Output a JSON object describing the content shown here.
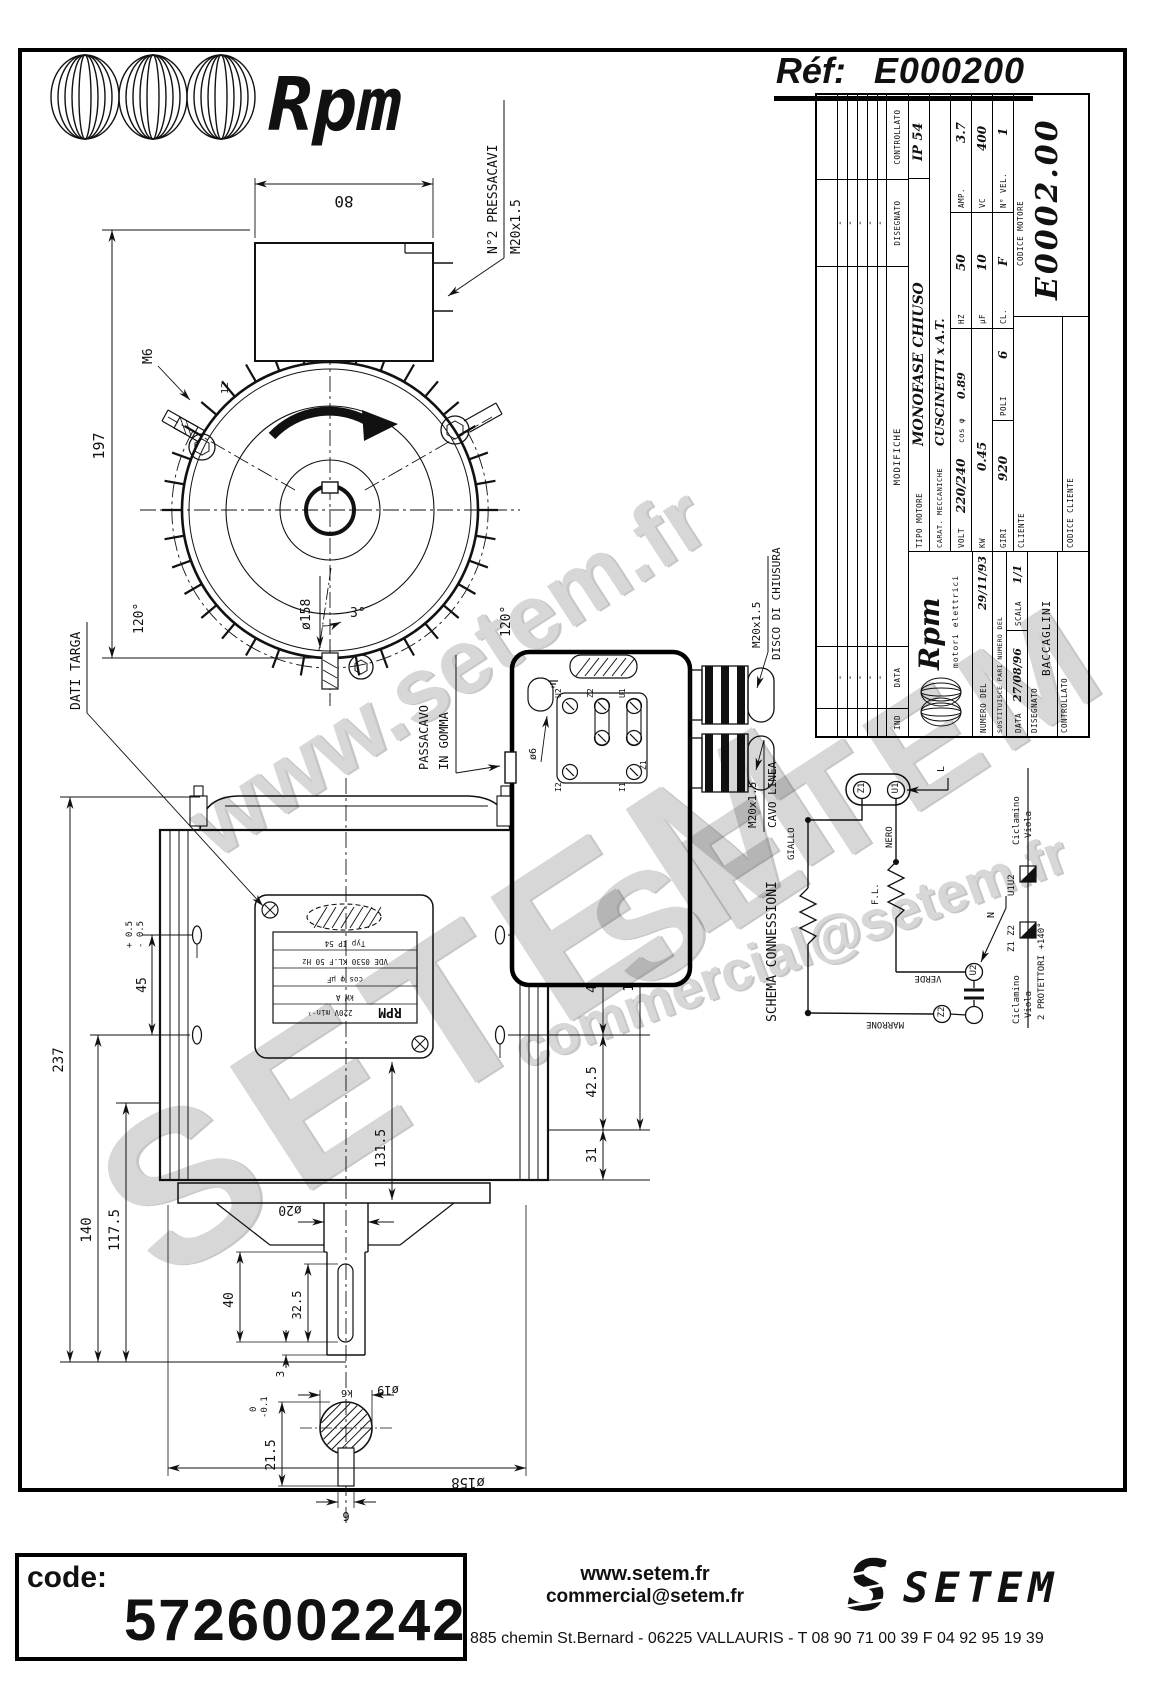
{
  "header": {
    "brand": "Rpm",
    "ref_label": "Réf:",
    "ref_value": "E000200"
  },
  "watermarks": {
    "line1": "www.setem.fr",
    "setem_big": "SETEM",
    "setem_mid": "SETEM",
    "email": "commercial@setem.fr"
  },
  "titleblock": {
    "dash": "-",
    "headers": {
      "ind": "IND",
      "data": "DATA",
      "modifiche": "MODIFICHE",
      "disegnato": "DISEGNATO",
      "controllato": "CONTROLLATO"
    },
    "ip": "IP 54",
    "tipo_label": "TIPO MOTORE",
    "tipo": "MONOFASE CHIUSO",
    "carat_label": "CARAT. MECCANICHE",
    "carat": "CUSCINETTI x A.T.",
    "volt_label": "VOLT",
    "volt": "220/240",
    "cos_label": "cos φ",
    "cos": "0.89",
    "hz_label": "HZ",
    "hz": "50",
    "amp_label": "AMP.",
    "amp": "3.7",
    "kw_label": "KW",
    "kw": "0.45",
    "uf_label": "μF",
    "uf": "10",
    "vc_label": "VC",
    "vc": "400",
    "giri_label": "GIRI",
    "giri": "920",
    "poli_label": "POLI",
    "poli": "6",
    "cl_label": "CL.",
    "cl": "F",
    "nvel_label": "N° VEL.",
    "nvel": "1",
    "cliente_label": "CLIENTE",
    "codice_motore_label": "CODICE MOTORE",
    "codice_motore": "E0002.00",
    "codice_cliente_label": "CODICE CLIENTE",
    "logo_text": "Rpm",
    "logo_sub": "motori elettrici",
    "numero_label": "NUMERO DEL",
    "numero": "29/11/93",
    "sostituisce_label": "SOSTITUISCE PARI NUMERO DEL",
    "data_label": "DATA",
    "data": "27/08/96",
    "scala_label": "SCALA",
    "scala": "1/1",
    "disegnato_value": "BACCAGLINI"
  },
  "front_view": {
    "dims": {
      "top": "80",
      "height": "197",
      "angle_left": "120°",
      "angle_right": "120°",
      "angle_small": "3°",
      "bolt_circle": "ø158",
      "stud": "M6",
      "stud_len": "12"
    },
    "label_pressacavi_1": "N°2 PRESSACAVI",
    "label_pressacavi_2": "M20x1.5"
  },
  "side_view": {
    "dims": {
      "total": "237",
      "d140": "140",
      "d117": "117.5",
      "d45": "45",
      "tol_plus": "+ 0.5",
      "tol_minus": "- 0.5",
      "d31_top": "31",
      "d43": "43.5",
      "d45r": "45",
      "d42": "42.5",
      "d31_bot": "31",
      "d131": "131",
      "d131_5": "131.5",
      "shaft": "ø20",
      "d40": "40",
      "d32": "32.5",
      "d3": "3"
    },
    "label_dati_targa": "DATI TARGA",
    "nameplate": [
      "Typ          IP 54",
      "VDE 0530 KL.F 50 Hz",
      "cos φ     μF",
      "kW       A",
      "220V  min⁻¹"
    ],
    "nameplate_logo": "RPM"
  },
  "box_detail": {
    "label_passacavo_1": "PASSACAVO",
    "label_passacavo_2": "IN GOMMA",
    "terminals": {
      "u2": "U2",
      "z2": "Z2",
      "u1": "U1",
      "i2": "I2",
      "i1": "I1",
      "z1": "Z1"
    },
    "dim_hole": "ø6",
    "gland_top_1": "M20x1.5",
    "gland_top_2": "DISCO DI CHIUSURA",
    "gland_bottom_1": "M20x1.5",
    "gland_bottom_2": "CAVO LINEA"
  },
  "shaft_detail": {
    "d215": "21.5",
    "tol_0": "0",
    "tol_01": "-0.1",
    "d19": "ø19",
    "k6": "k6",
    "d6": "6",
    "d158": "ø158"
  },
  "schema": {
    "title": "SCHEMA CONNESSIONI",
    "z1": "Z1",
    "u1": "U1",
    "u2": "U2",
    "z2": "Z2",
    "l": "L",
    "n": "N",
    "giallo": "GIALLO",
    "nero": "NERO",
    "fl": "F.L.",
    "verde": "VERDE",
    "marrone": "MARRONE",
    "prot_top_1": "Ciclamino",
    "prot_top_2": "Viola",
    "prot_u1u2": "U1U2",
    "prot_z1z2": "Z1 Z2",
    "prot_bottom_1": "Ciclamino",
    "prot_bottom_2": "Viola",
    "prot_label": "2 PROTETTORI +140°"
  },
  "footer": {
    "code_label": "code:",
    "code_value": "5726002242",
    "site": "www.setem.fr",
    "email": "commercial@setem.fr",
    "address": "885 chemin St.Bernard  -  06225 VALLAURIS  -  T 08 90 71 00 39   F 04 92 95 19 39",
    "logo_text": "SETEM",
    "logo_s": "S"
  }
}
